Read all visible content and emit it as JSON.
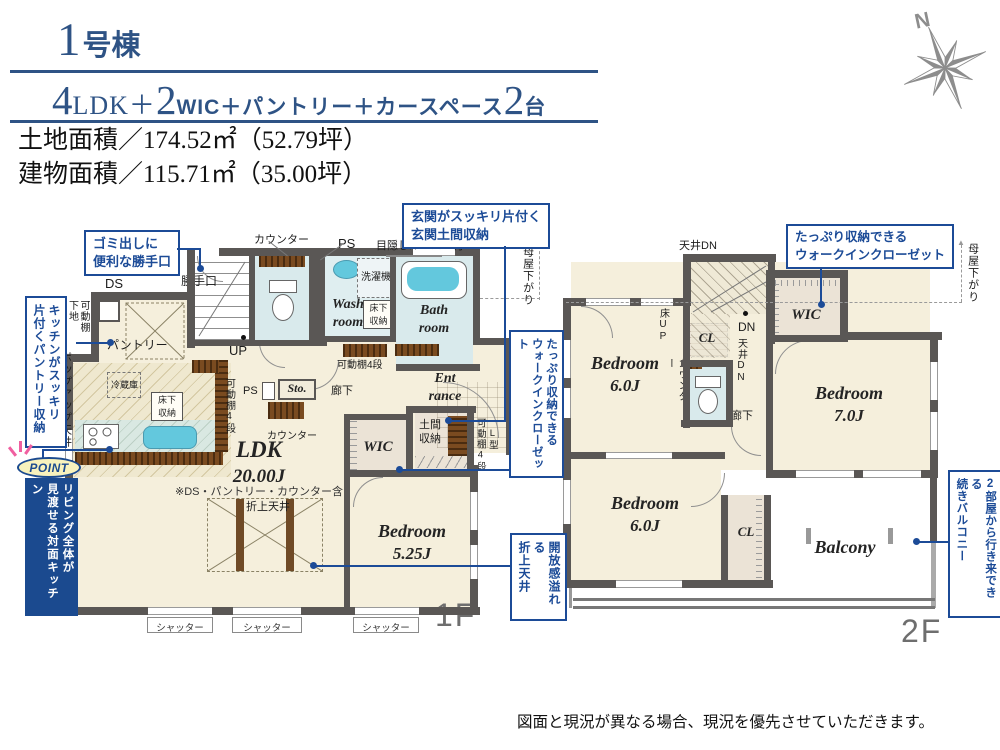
{
  "palette": {
    "accent_blue": "#1c4b97",
    "header_blue": "#2e5385",
    "wall_gray": "#5a5755",
    "floor_beige": "#f5efdc",
    "wet_blue": "#d9eaec",
    "fixture_cyan": "#63c8dd",
    "closet_beige": "#ebe3d6",
    "wood_brown": "#7a4b20",
    "point_navy": "#1b4a8f",
    "point_badge_yellow": "#f8f2bd",
    "ray_pink": "#f05fa0",
    "compass_gray": "#8d8d8d"
  },
  "header": {
    "building_no": "1",
    "building_suffix": "号棟",
    "spec": {
      "n1": "4",
      "t1": "LDK＋",
      "n2": "2",
      "t2": "WIC＋パントリー＋カースペース",
      "n3": "2",
      "t3": "台"
    },
    "land_area": "土地面積／174.52㎡（52.79坪）",
    "building_area": "建物面積／115.71㎡（35.00坪）"
  },
  "compass": {
    "label": "N"
  },
  "floor1": {
    "floor_label": "1F",
    "rooms": {
      "ldk_name": "LDK",
      "ldk_size": "20.00J",
      "ldk_note": "※DS・パントリー・カウンター含",
      "bedroom_name": "Bedroom",
      "bedroom_size": "5.25J",
      "wash_line1": "Wash",
      "wash_line2": "room",
      "bath_line1": "Bath",
      "bath_line2": "room",
      "entrance_line1": "Ent",
      "entrance_line2": "rance",
      "wic": "WIC",
      "doma_line1": "土間",
      "doma_line2": "収納",
      "sto": "Sto.",
      "pantry": "パントリー",
      "hallway": "廊下"
    },
    "labels": {
      "ds": "DS",
      "back_door": "勝手口",
      "counter_top": "カウンター",
      "ps_top": "PS",
      "louver": "目隠しルーバー付",
      "moya": "母屋下がり",
      "washer": "洗濯機",
      "underfloor_wash": "床下収納",
      "shelf4_wash": "可動棚4段",
      "up": "UP",
      "ps2": "PS",
      "counter_mid": "カウンター",
      "shelf4_left": "可動棚4段",
      "shelf_backing_1": "可動棚",
      "shelf_backing_2": "下地",
      "popup_ceiling": "ポップアップ天井",
      "fridge": "冷蔵庫",
      "underfloor_kitchen": "床下収納",
      "coffered": "折上天井",
      "shelf4_right": "可動棚4段",
      "l_type": "L型",
      "shutter": "シャッター"
    }
  },
  "floor2": {
    "floor_label": "2F",
    "rooms": {
      "bed1_name": "Bedroom",
      "bed1_size": "6.0J",
      "bed2_name": "Bedroom",
      "bed2_size": "7.0J",
      "bed3_name": "Bedroom",
      "bed3_size": "6.0J",
      "wic": "WIC",
      "cl1": "CL",
      "cl2": "CL",
      "balcony": "Balcony",
      "hallway": "廊下"
    },
    "labels": {
      "ceil_dn_top": "天井DN",
      "floor_up": "床UP",
      "dn": "DN",
      "ceil_dn_side": "天井DN",
      "counter": "カウンター",
      "moya": "母屋下がり"
    }
  },
  "callouts": {
    "c1_line1": "ゴミ出しに",
    "c1_line2": "便利な勝手口",
    "c2_line1": "玄関がスッキリ片付く",
    "c2_line2": "玄関土間収納",
    "c3_col1": "キッチンがスッキリ",
    "c3_col2": "片付くパントリー収納",
    "point_badge": "POINT",
    "point_col1": "リビング全体が",
    "point_col2": "見渡せる対面キッチン",
    "c5_col1": "たっぷり収納できる",
    "c5_col2": "ウォークインクローゼット",
    "c6_col1": "開放感溢れる",
    "c6_col2": "折上天井",
    "c7_line1": "たっぷり収納できる",
    "c7_line2": "ウォークインクローゼット",
    "c8_col1": "2部屋から行き来できる",
    "c8_col2": "続きバルコニー"
  },
  "footer": {
    "disclaimer": "図面と現況が異なる場合、現況を優先させていただきます。"
  }
}
